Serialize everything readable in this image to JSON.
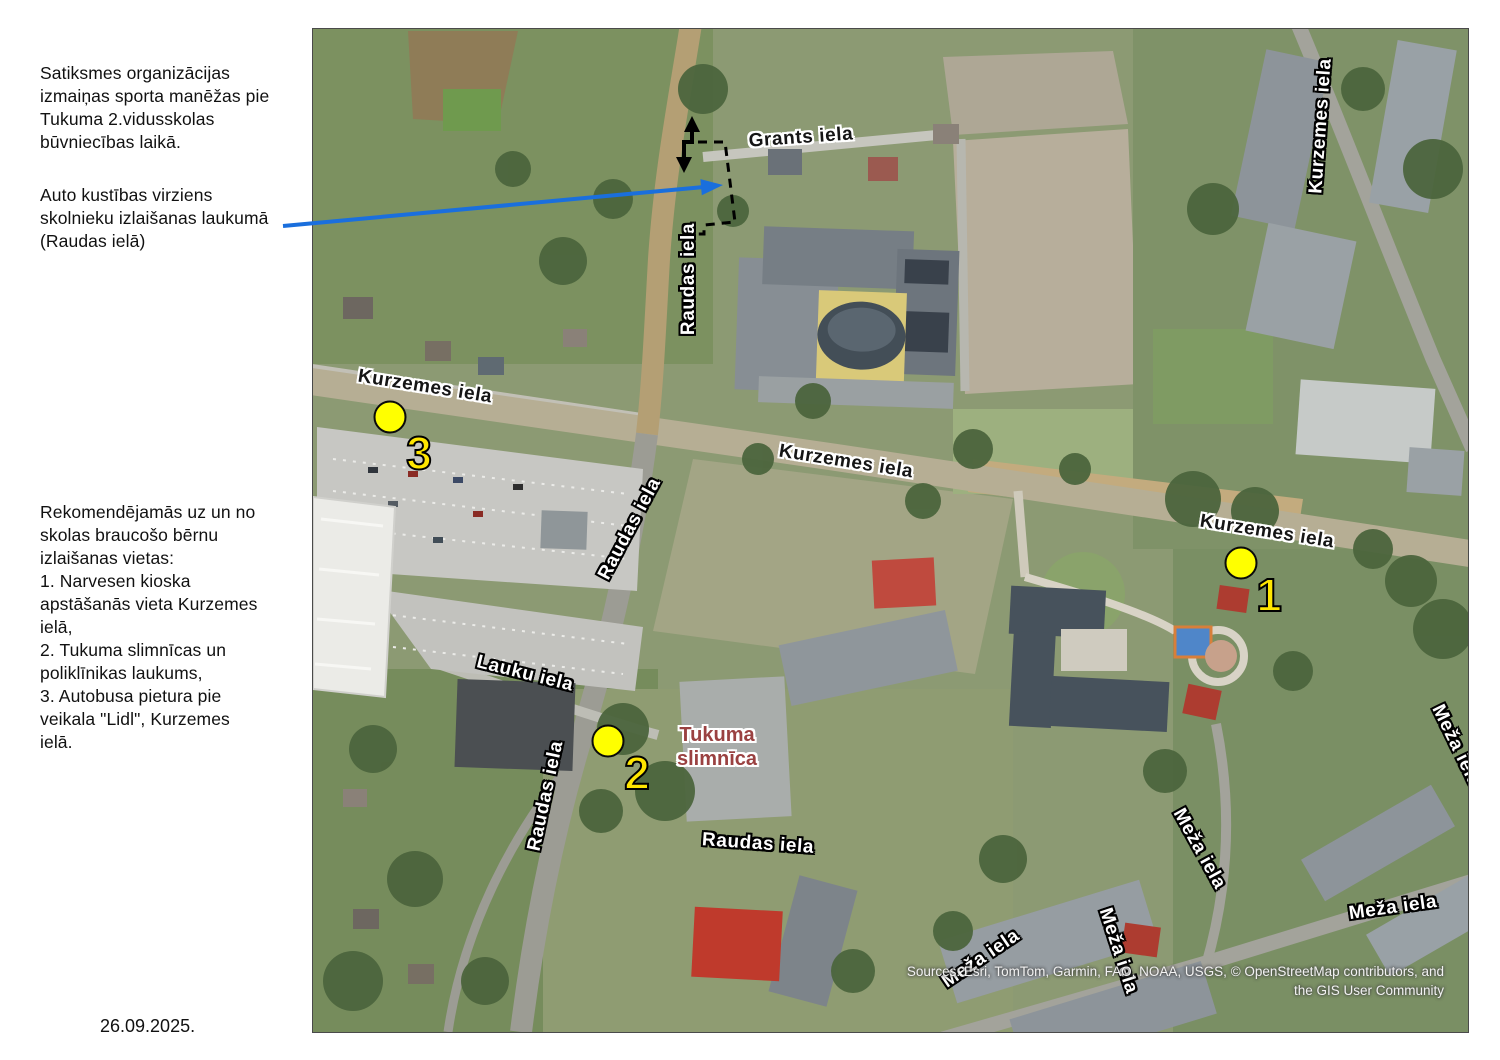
{
  "annotations": {
    "construction_note": "Satiksmes organizācijas\nizmaiņas sporta manēžas pie\nTukuma 2.vidusskolas\nbūvniecības laikā.",
    "direction_note": "Auto kustības virziens\nskolnieku izlaišanas laukumā\n(Raudas ielā)",
    "recommendations": "Rekomendējamās uz un no\nskolas braucošo bērnu\nizlaišanas vietas:\n1. Narvesen kioska\napstāšanās vieta Kurzemes\nielā,\n2. Tukuma slimnīcas un\npoliklīnikas laukums,\n3. Autobusa pietura pie\nveikala \"Lidl\", Kurzemes\nielā.",
    "date": "26.09.2025."
  },
  "map": {
    "street_labels": [
      {
        "id": "grants-iela",
        "text": "Grants iela"
      },
      {
        "id": "raudas-iela-top",
        "text": "Raudas iela"
      },
      {
        "id": "kurzemes-iela-left",
        "text": "Kurzemes iela"
      },
      {
        "id": "kurzemes-iela-mid",
        "text": "Kurzemes iela"
      },
      {
        "id": "kurzemes-iela-right",
        "text": "Kurzemes iela"
      },
      {
        "id": "kurzemes-iela-topright",
        "text": "Kurzemes iela"
      },
      {
        "id": "raudas-iela-mid",
        "text": "Raudas iela"
      },
      {
        "id": "raudas-iela-lower",
        "text": "Raudas iela"
      },
      {
        "id": "raudas-iela-bottom",
        "text": "Raudas iela"
      },
      {
        "id": "lauku-iela",
        "text": "Lauku iela"
      },
      {
        "id": "meza-iela-right",
        "text": "Meža iela"
      },
      {
        "id": "meza-iela-se",
        "text": "Meža iela"
      },
      {
        "id": "meza-iela-bottomright",
        "text": "Meža iela"
      },
      {
        "id": "meza-iela-bottomcenter",
        "text": "Meža iela"
      },
      {
        "id": "meza-iela-bottomcut",
        "text": "Meža iela"
      }
    ],
    "poi_label": {
      "text": "Tukuma\nslimnīca"
    },
    "markers": [
      {
        "label": "1"
      },
      {
        "label": "2"
      },
      {
        "label": "3"
      }
    ],
    "attribution_line1": "Sources: Esri, TomTom, Garmin, FAO, NOAA, USGS, © OpenStreetMap contributors, and",
    "attribution_line2": "the GIS User Community"
  },
  "colors": {
    "marker_fill": "#ffff00",
    "marker_number": "#ffe600",
    "direction_arrow_blue": "#1a6fdd",
    "hospital_label": "#9a4141",
    "street_label_light": "#ffffff",
    "street_label_dark": "#151515"
  }
}
